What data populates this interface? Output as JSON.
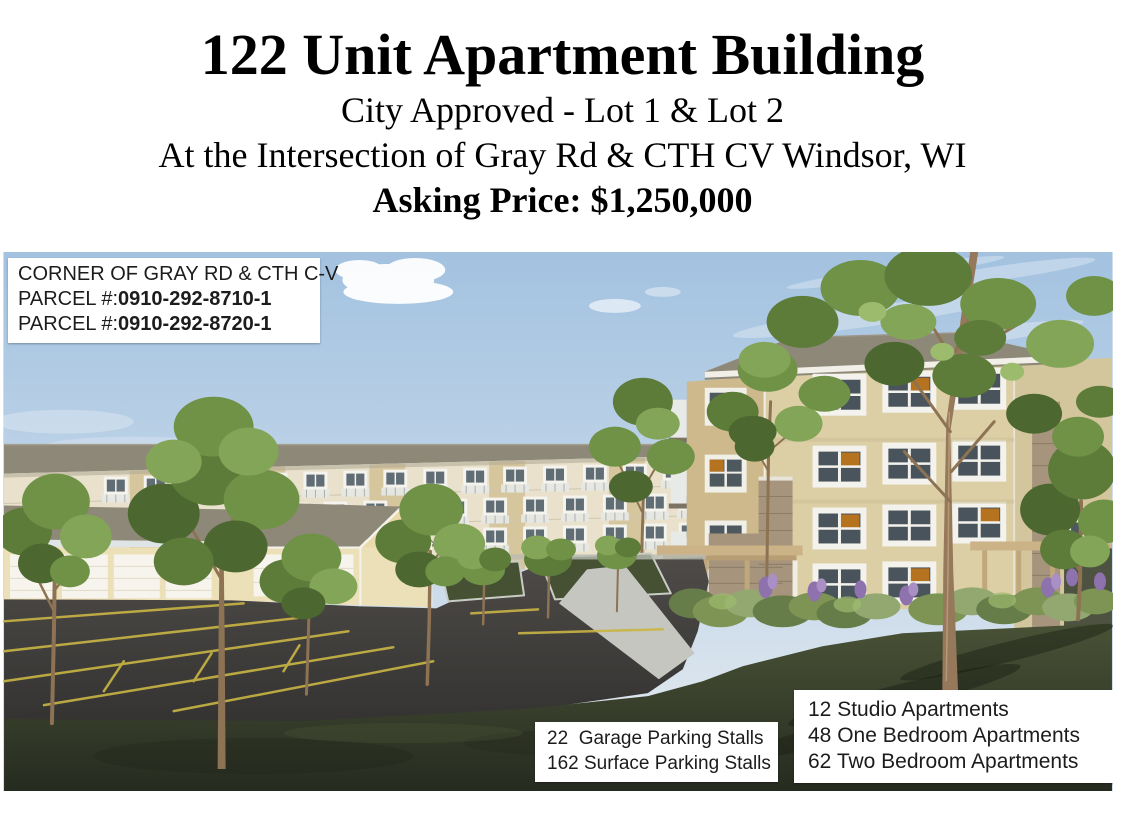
{
  "header": {
    "title": "122 Unit Apartment Building",
    "approval": "City Approved - Lot 1 & Lot 2",
    "location": "At the Intersection of Gray Rd & CTH CV Windsor, WI",
    "asking_price": "Asking Price: $1,250,000"
  },
  "overlays": {
    "parcel": {
      "corner": "CORNER OF GRAY RD & CTH C-V",
      "label": "PARCEL #:",
      "number1": "0910-292-8710-1",
      "number2": "0910-292-8720-1"
    },
    "parking": {
      "line1": "22  Garage Parking Stalls",
      "line2": "162 Surface Parking Stalls"
    },
    "units": {
      "line1": "12 Studio Apartments",
      "line2": "48 One Bedroom Apartments",
      "line3": "62 Two Bedroom Apartments"
    }
  },
  "rendering": {
    "description": "Architectural rendering of a 4-story tan apartment building with stone accents, a long rear apartment wing, single-story garage buildings, surface parking lot with yellow stalls, lawns and deciduous trees under a blue sky"
  },
  "palette": {
    "roof": "#8e8878",
    "bg-wall": "#e9e1cb",
    "tan-panel": "#d6c69e",
    "main-wall": "#dccfa6",
    "wing-wall": "#cdb98c",
    "right-wall": "#d3c59c",
    "cream": "#ece0b8",
    "stone": "#a6947d",
    "stall": "#c9b544",
    "trunk": "#8d7354",
    "flower": "#8e72ad",
    "sky": "#a3c2e0",
    "asphalt": "#3d3c3b",
    "grass": "#363d2c",
    "text": "#1c1c1c"
  }
}
